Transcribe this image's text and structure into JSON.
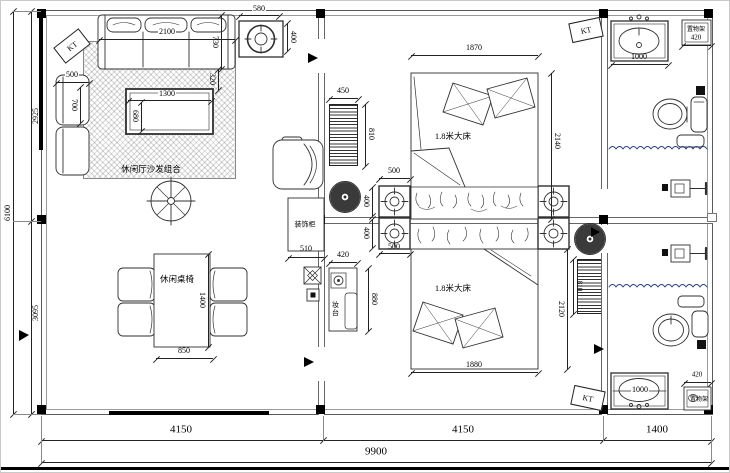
{
  "drawing_type": "residential floor plan",
  "colors": {
    "line": "#333333",
    "wall": "#666666",
    "column": "#000000",
    "water_wave": "#2b3f8c",
    "hatch": "#333333"
  },
  "labels": {
    "kt": "KT",
    "sofa_group": "休闲厅沙发组合",
    "leisure_table": "休闲桌椅",
    "bed": "1.8米大床",
    "dressing_table": "妆台",
    "decor_cabinet": "装饰柜",
    "shelf": "置物架"
  },
  "dims": {
    "left_total": "6100",
    "left_upper": "2925",
    "left_lower": "3095",
    "bottom_left": "4150",
    "bottom_mid": "4150",
    "bottom_right": "1400",
    "bottom_total": "9900",
    "sofa_width": "2100",
    "sofa_depth": "730",
    "sofa_side": "320",
    "side_sofa_width": "500",
    "side_sofa_depth": "700",
    "coffee_table_width": "1300",
    "coffee_table_depth": "680",
    "ceiling_fixture_width": "580",
    "ceiling_fixture_height": "400",
    "radiator1_width": "450",
    "radiator1_height": "810",
    "bed1_width": "1870",
    "bed1_height": "2140",
    "downlight_top_span": "500",
    "downlight_top_size": "400",
    "downlight_bottom_size": "400",
    "downlight_bottom_span": "500",
    "cabinet_width": "510",
    "dresser_width": "420",
    "dresser_height": "880",
    "table_width": "850",
    "table_length": "1400",
    "bed2_width": "1880",
    "bed2_height": "2120",
    "radiator2_height": "810",
    "sink1_width": "1000",
    "shelf1_width": "420",
    "sink2_width": "1000",
    "shelf2_width": "420"
  }
}
